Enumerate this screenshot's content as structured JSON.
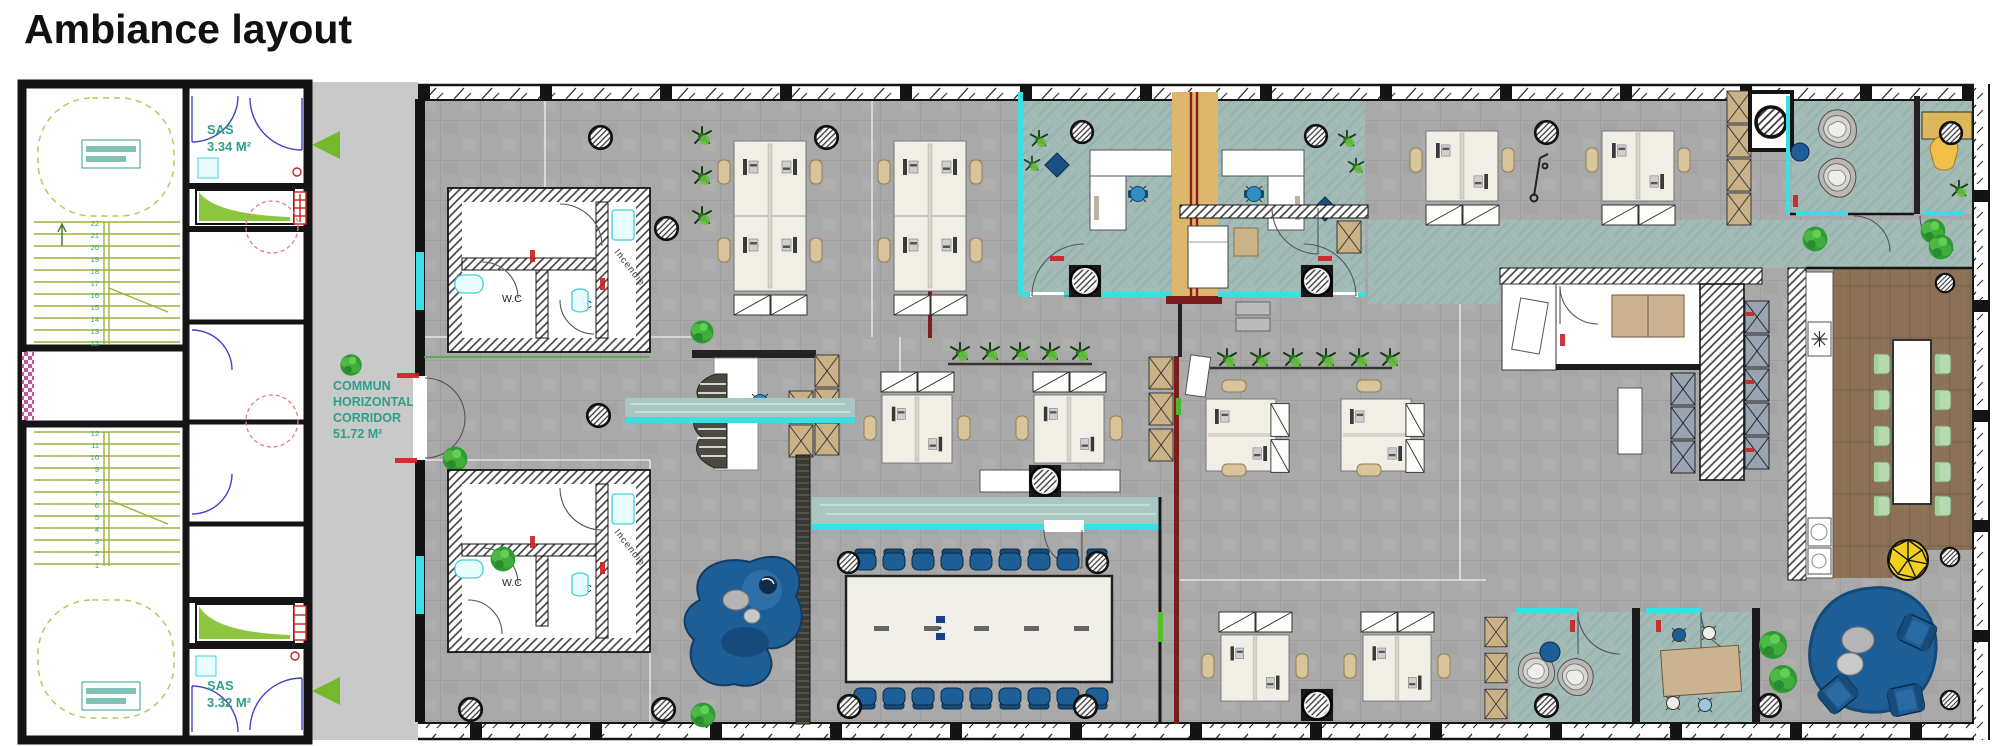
{
  "page": {
    "title": "Ambiance layout"
  },
  "colors": {
    "wall": "#141414",
    "floor_gray": "#a9a9a9",
    "corridor_gray": "#c9c9c9",
    "carpet_teal": "#a3bbb6",
    "wood_brown": "#8b7156",
    "glass_cyan": "#3adfe3",
    "label_teal": "#2f9f89",
    "accent_green": "#76b82d",
    "stair_green": "#9db13f",
    "alert_red": "#cc2020",
    "maroon_wall": "#7c1d1d",
    "furniture_navy": "#1d5e96",
    "chair_blue": "#2e8fc0",
    "locker_tan": "#cbb286",
    "desk_cream": "#f1efe5",
    "divider_tan": "#dcb76c",
    "pouf_yellow": "#f2d11e"
  },
  "plan": {
    "labels": {
      "sas_top": {
        "name": "SAS",
        "area": "3.34 M²"
      },
      "sas_bottom": {
        "name": "SAS",
        "area": "3.32 M²"
      },
      "corridor": {
        "lines": [
          "COMMUN",
          "HORIZONTAL",
          "CORRIDOR",
          "51.72 M²"
        ]
      },
      "wc": "W.C",
      "incendie": "Incendie"
    },
    "stairs": {
      "top_numbers": [
        "22",
        "21",
        "20",
        "19",
        "18",
        "17",
        "16",
        "15",
        "14",
        "13",
        "12"
      ],
      "bottom_numbers": [
        "12",
        "11",
        "10",
        "9",
        "8",
        "7",
        "6",
        "5",
        "4",
        "3",
        "2",
        "1"
      ]
    }
  }
}
